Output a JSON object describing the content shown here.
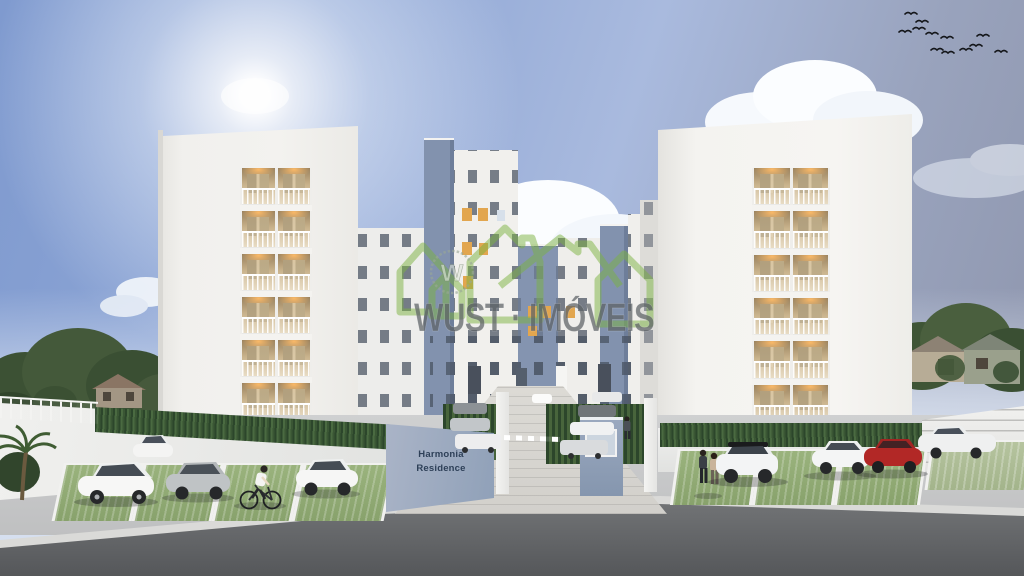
{
  "watermark": {
    "brand": "WUST · IMÓVEIS",
    "emblem_letter": "W",
    "green": "#7cb342",
    "text_color": "#5d6266"
  },
  "entrance_sign": {
    "line1": "Harmonia",
    "line2": "Residence",
    "panel_color": "#9aa7bd",
    "text_color": "#2e4058"
  },
  "scene": {
    "description": "3D architectural rendering of the Harmonia Residence apartment complex",
    "sky": {
      "top": "#7f9acf",
      "top_right": "#8e95ac",
      "horizon": "#dde6f3",
      "sun_glow": "#ffffff"
    },
    "towers": {
      "count": 2,
      "balcony_floors_visible": 6,
      "facade": "#f2f1ee",
      "balcony_light": "#e2a64f"
    },
    "mid_buildings": {
      "accent_blue": "#8292ae",
      "facade_white": "#f0efec"
    },
    "ground": {
      "asphalt": "#67696b",
      "grass_parking": "#93ac77",
      "perimeter_wall": "#ecedec",
      "driveway_pavers": "#d8d6d1"
    },
    "objects": {
      "birds_in_flock": 12,
      "cyclist": 1,
      "pedestrians": 3,
      "left_parking_cars": [
        "white hatchback",
        "silver compact",
        "white compact"
      ],
      "right_parking_cars": [
        "white SUV with black roof",
        "white sedan",
        "red sedan",
        "white car"
      ],
      "background_elements": [
        "trees",
        "neighborhood houses",
        "palm tree",
        "clouds",
        "sun glow"
      ]
    }
  }
}
